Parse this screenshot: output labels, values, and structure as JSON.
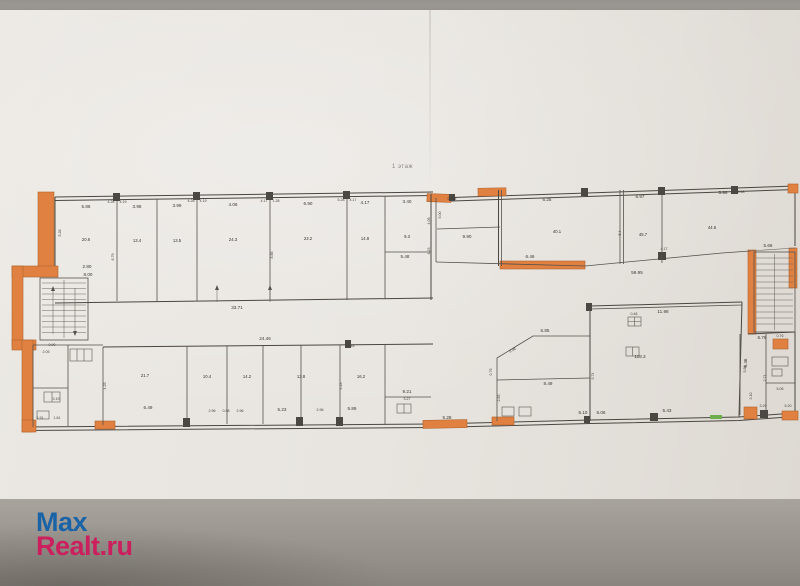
{
  "photo": {
    "floor_label": "1 этаж"
  },
  "watermark": {
    "line1": "Max",
    "line2": "Realt.ru",
    "blue": "#1a63a6",
    "red": "#cb1f5e"
  },
  "plan": {
    "type": "floor-plan",
    "wall_color": "#4a4640",
    "highlight_color": "#e08142",
    "paper_color": "#ebe8e3",
    "background_color": "#a39f9a",
    "accent_green": "#6fae4e",
    "labels": [
      "5.86",
      "3.98",
      "3.99",
      "4.06",
      "6.90",
      "4.17",
      "3.40",
      "4.28",
      "4.19",
      "4.28",
      "4.19",
      "4.17",
      "1.28",
      "5.28",
      "4.17",
      "5.28",
      "8.79",
      "8.86",
      "5.48",
      "33.71",
      "2.80",
      "8.00",
      "20.6",
      "13.4",
      "13.5",
      "24.3",
      "23.2",
      "14.8",
      "9.3",
      "2.05",
      "0.90",
      "3.19",
      "1.91",
      "1.61",
      "24.46",
      "6.49",
      "2.96",
      "0.98",
      "2.96",
      "5.23",
      "2.96",
      "5.89",
      "9.21",
      "3.27",
      "0.48",
      "4.25",
      "4.23",
      "21.7",
      "10.4",
      "14.2",
      "13.8",
      "16.2",
      "0.99",
      "5.00",
      "9.90",
      "4.05",
      "4.23",
      "6.25",
      "6.97",
      "5.96",
      "5.48",
      "40.1",
      "45.7",
      "44.6",
      "5.4",
      "6.46",
      "59.95",
      "4.17",
      "5.66",
      "11.98",
      "8.46",
      "5.43",
      "118.3",
      "0.46",
      "6.85",
      "5.98",
      "0.75",
      "2.83",
      "8.49",
      "5.74",
      "5.10",
      "5.06",
      "5.28",
      "6.76",
      "0.76",
      "5.86",
      "2.71",
      "5.06",
      "3.29",
      "5.20",
      "3.10"
    ]
  }
}
